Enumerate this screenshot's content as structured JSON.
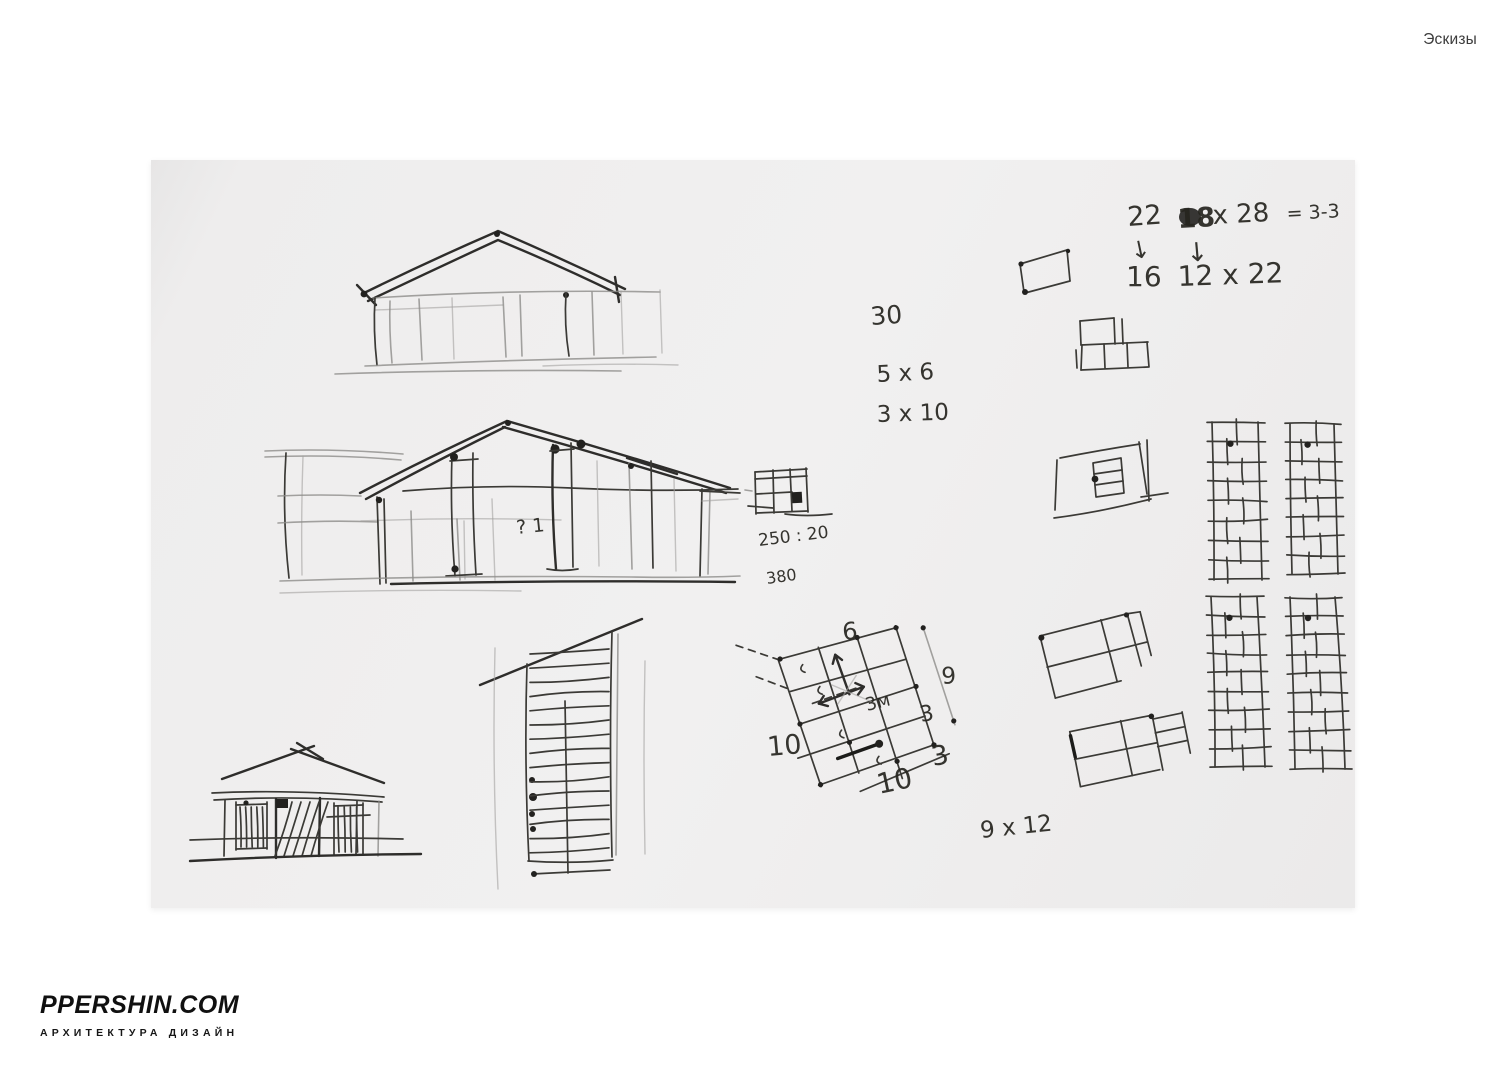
{
  "header": {
    "title": "Эскизы"
  },
  "footer": {
    "brand": "PPERSHIN.COM",
    "tagline": "АРХИТЕКТУРА ДИЗАЙН"
  },
  "colors": {
    "page": "#ffffff",
    "paper": "#eeeded",
    "ink": "#2e2d2b",
    "pencil": "#8d8c89"
  },
  "annotations": {
    "calc": {
      "r1c1": "22",
      "r1c2": "18",
      "r1c3": "x 28",
      "r1c4": "= 3-3",
      "arrow": "↓",
      "r2c1": "16",
      "r2c2": "12 x 22"
    },
    "notes": {
      "n30": "30",
      "n5x6": "5 x 6",
      "n3x10": "3 x 10",
      "n250": "250 : 20",
      "n380": "380",
      "n9x12": "9 x 12",
      "question": "? 1"
    },
    "plan": {
      "top": "6",
      "left": "10",
      "center": "3м",
      "right_upper": "3",
      "right_lower": "3",
      "bottom": "10",
      "side": "9"
    }
  }
}
